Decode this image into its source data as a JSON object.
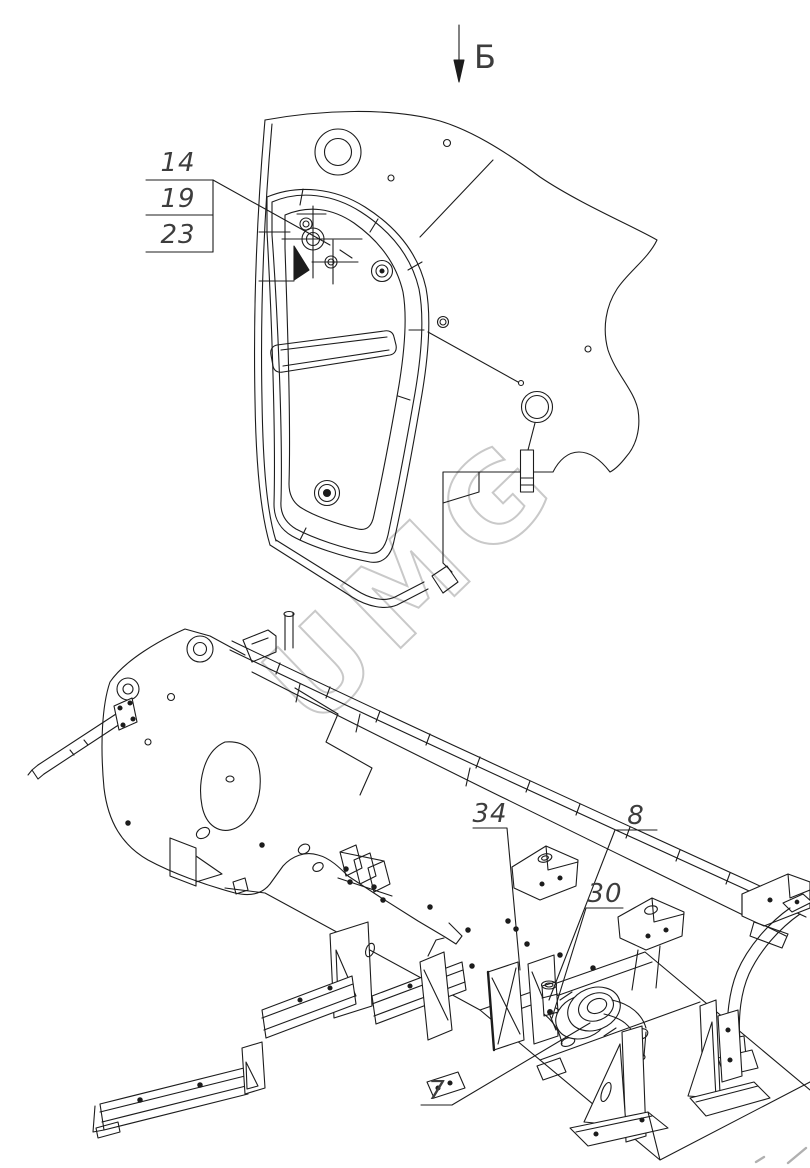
{
  "page": {
    "background": "#ffffff",
    "type": "technical-assembly-drawing"
  },
  "view_arrow": {
    "label": "Б"
  },
  "callout_table": {
    "rows": [
      "14",
      "19",
      "23"
    ]
  },
  "part_labels": {
    "label_34": "34",
    "label_8": "8",
    "label_30": "30",
    "label_7": "7"
  },
  "watermark": {
    "text": "UMG",
    "color": "#c9c9c9"
  },
  "colors": {
    "line": "#1c1c1c",
    "label": "#3d3d3d",
    "corner_marks": "#b0b0b0"
  }
}
